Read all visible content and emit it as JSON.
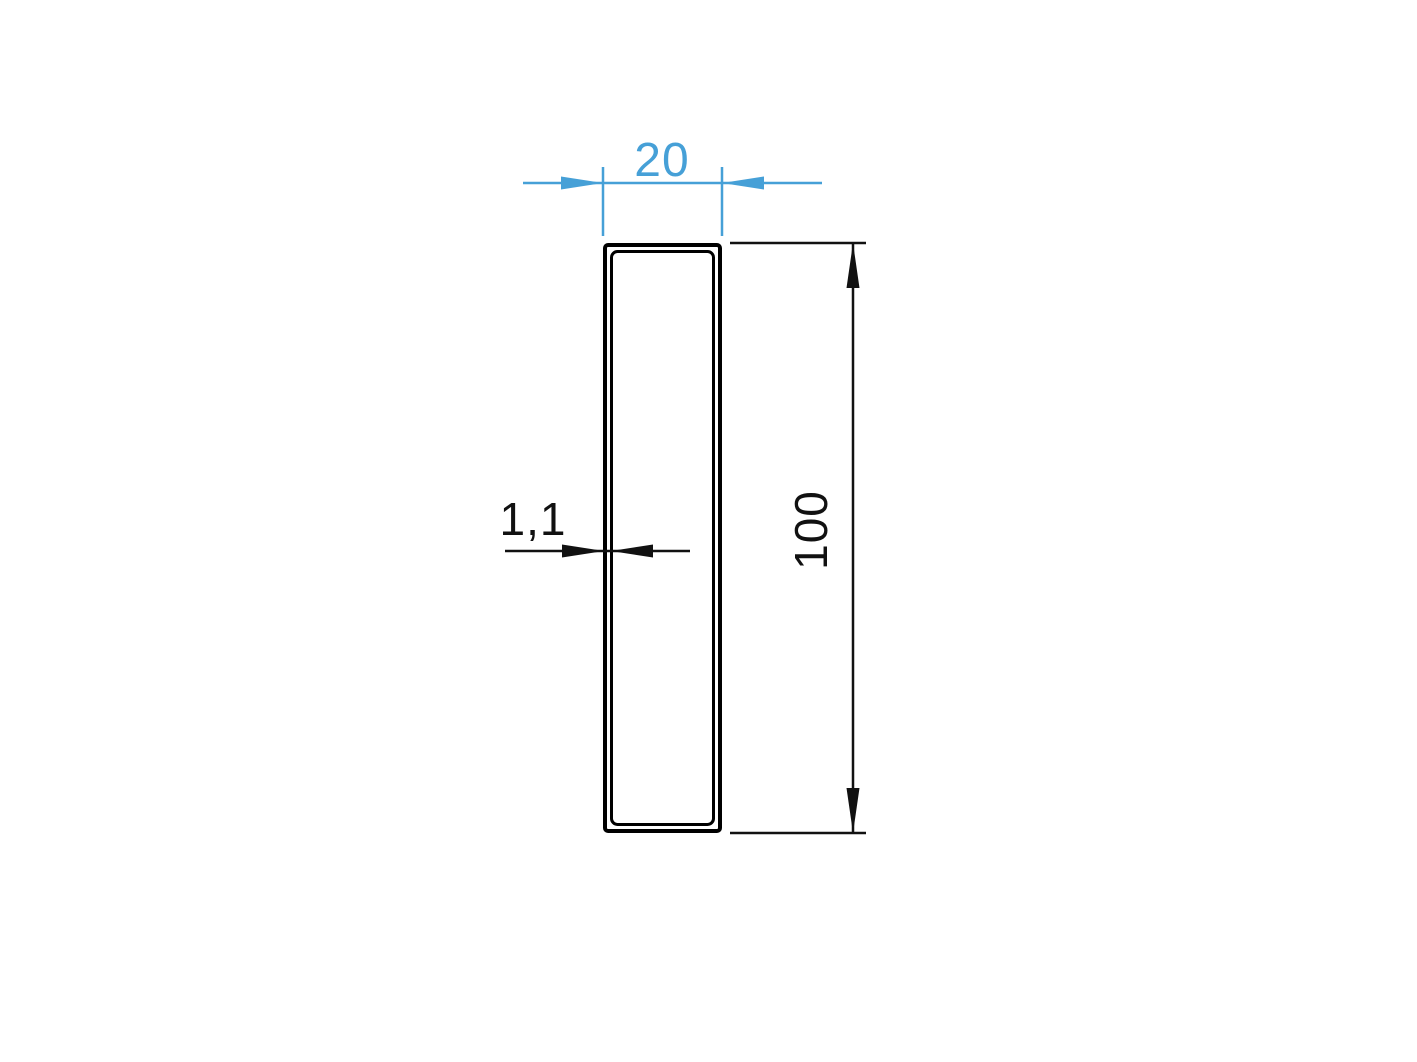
{
  "drawing": {
    "type": "technical-cross-section",
    "shape": "rectangular-tube-profile",
    "dimensions": {
      "width": {
        "label": "20",
        "value": 20
      },
      "height": {
        "label": "100",
        "value": 100
      },
      "wall_thickness": {
        "label": "1,1",
        "value": 1.1
      }
    },
    "colors": {
      "width_dimension": "#46a0d7",
      "dark_dimension": "#111111",
      "outline": "#000000",
      "background": "#ffffff"
    }
  }
}
